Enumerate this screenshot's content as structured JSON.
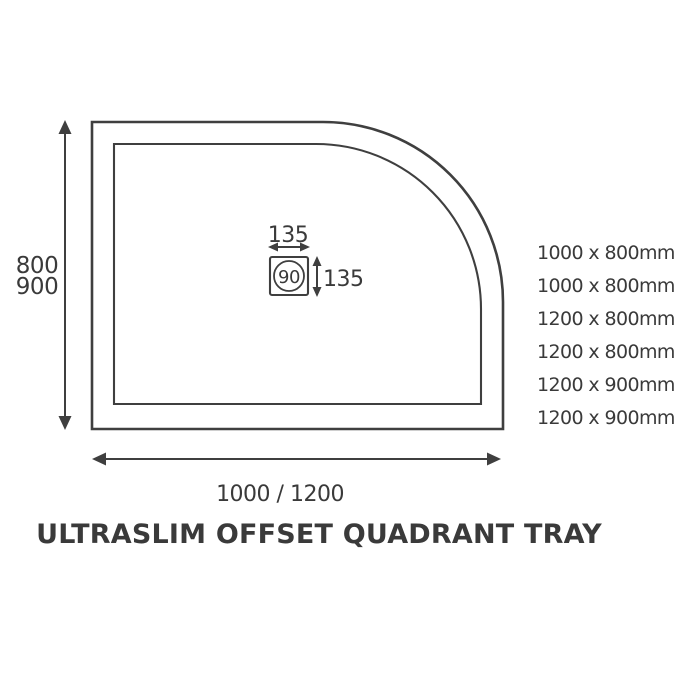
{
  "title": "ULTRASLIM OFFSET QUADRANT TRAY",
  "dimensions": {
    "depth_label_line1": "800",
    "depth_label_line2": "900",
    "width_label": "1000 / 1200",
    "waste_width_label": "135",
    "waste_height_label": "135",
    "waste_diameter_label": "90"
  },
  "available_sizes": [
    "1000 x 800mm",
    "1000 x 800mm",
    "1200 x 800mm",
    "1200 x 800mm",
    "1200 x 900mm",
    "1200 x 900mm"
  ],
  "colors": {
    "line": "#3f3f3f",
    "text": "#3a3a3a",
    "background": "#ffffff"
  }
}
